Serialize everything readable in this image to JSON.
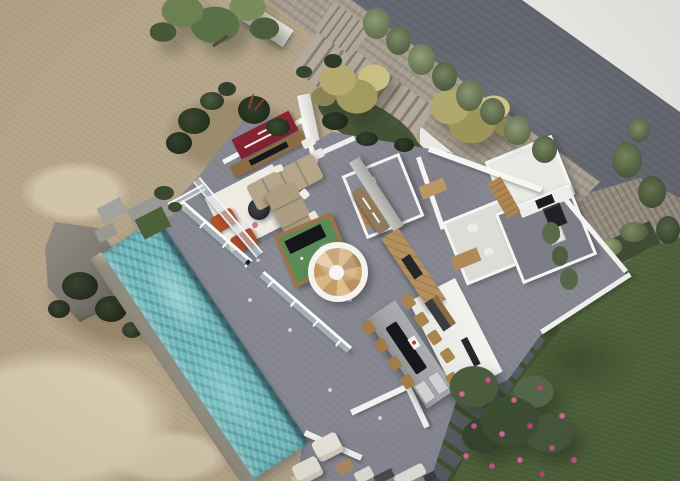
{
  "meta": {
    "title": "Aerial 3D render of a modern villa with infinity pool, roofless interior view",
    "width_px": 680,
    "height_px": 481
  },
  "palette": {
    "backdrop": "#eae9e5",
    "dirt": "#b2a287",
    "dirt-dark": "#8a7a5e",
    "dirt-light": "#d8cbb0",
    "road": "#62656e",
    "stone": "#a69d91",
    "stone-dark": "#857c70",
    "wall": "#f4f4f1",
    "concrete": "#bcbcb8",
    "floor": "#84858f",
    "floor-dark": "#71727e",
    "pool": "#6eb6b9",
    "coping": "#b2ab99",
    "lawn": "#4d6139",
    "garden": "#41502f",
    "foliage": "#5a7046",
    "foliage-dark": "#2e3a26",
    "olive": "#b0a76c",
    "bamboo": "#7e8b67",
    "flower": "#c8538a",
    "red-wall": "#7d2130",
    "wood": "#b08a58",
    "wood-dark": "#8a6b44",
    "sofa": "#b4a58b",
    "rug": "#eeebe3",
    "billiard-green": "#5a8a55",
    "charcoal": "#1b1c20",
    "lounger": "#e5e1d6",
    "island-top": "#a2a3a6",
    "rust": "#b0502c",
    "rock": "#7b776f",
    "glass": "rgba(200,220,226,0.5)"
  },
  "scene": {
    "type": "architectural-aerial-render",
    "elements": [
      {
        "name": "scrub-terrain",
        "desc": "dry tan scrubland on west side"
      },
      {
        "name": "dirt-band",
        "desc": "bare earth strip along upper boundary"
      },
      {
        "name": "rock-outcrop",
        "desc": "gray boulder beside pool head"
      },
      {
        "name": "street-road",
        "desc": "dark asphalt road at top right"
      },
      {
        "name": "stone-stair-path",
        "desc": "stone staircase descending from street"
      },
      {
        "name": "courtyard",
        "desc": "stone paved entry court with olive trees"
      },
      {
        "name": "villa-floor",
        "desc": "gray concrete main floor and terrace"
      },
      {
        "name": "living-room",
        "desc": "open living room with red accent wall"
      },
      {
        "name": "red-accent-wall",
        "desc": "maroon media wall with shelf"
      },
      {
        "name": "tv-console",
        "desc": "wood console with television"
      },
      {
        "name": "sofa",
        "desc": "L-shaped taupe sectional with white pillows"
      },
      {
        "name": "rug",
        "desc": "white area rug with round black coffee table"
      },
      {
        "name": "billiard-table",
        "desc": "green pool table partly covered"
      },
      {
        "name": "spiral-staircase",
        "desc": "round wooden spiral stair in white drum"
      },
      {
        "name": "entry-hall",
        "desc": "concrete walled entry with wood sideboard"
      },
      {
        "name": "east-wing-rooms",
        "desc": "white-walled bathrooms, laundry, kitchen"
      },
      {
        "name": "kitchen-appliances",
        "desc": "black cooktop column and washing machine"
      },
      {
        "name": "outdoor-kitchen",
        "desc": "timber cabinets with grill"
      },
      {
        "name": "dining-island",
        "desc": "long concrete table with sinks"
      },
      {
        "name": "dining-chairs",
        "desc": "timber chairs around island"
      },
      {
        "name": "swimming-pool",
        "desc": "long turquoise lap pool"
      },
      {
        "name": "glass-balustrade",
        "desc": "framed glass railing along terrace edge"
      },
      {
        "name": "sun-loungers",
        "desc": "white outdoor seats at pool end"
      },
      {
        "name": "lawn",
        "desc": "large green lawn southeast"
      },
      {
        "name": "flowering-tree",
        "desc": "pink blossom tree over stepping stones"
      },
      {
        "name": "stepping-stones",
        "desc": "slab path through garden"
      },
      {
        "name": "planter-beds",
        "desc": "stone walled planters with gray-green shrubs"
      },
      {
        "name": "olive-trees",
        "desc": "yellow-green canopies in courtyard"
      },
      {
        "name": "bamboo-row",
        "desc": "bamboo screen between stairs and road"
      },
      {
        "name": "shade-tree",
        "desc": "large green tree at top left"
      }
    ]
  }
}
